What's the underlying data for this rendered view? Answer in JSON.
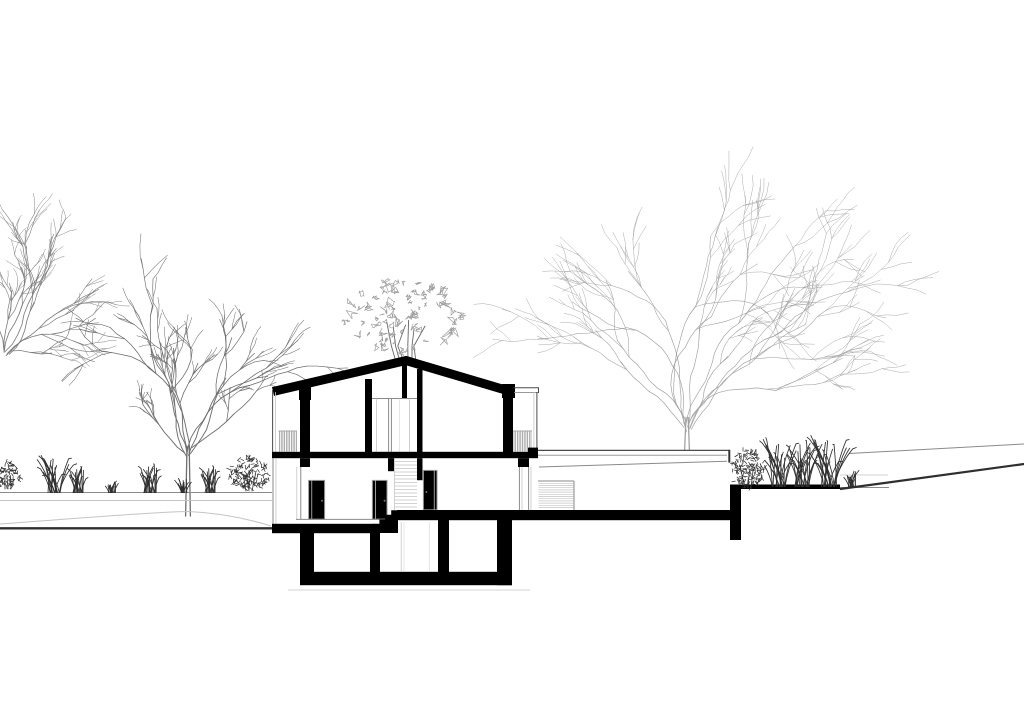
{
  "palette": {
    "background": "#ffffff",
    "ink": "#000000",
    "cut_line": "#2e2e2e",
    "line_dark": "#4a4a4a",
    "line_mid": "#8a8a8a",
    "line_light": "#c4c4c4",
    "tree_left_far": "#7d7d7d",
    "tree_left": "#6e6e6e",
    "tree_right": "#a2a2a2",
    "shrub_canopy": "#9c9c9c",
    "shrub_stem": "#666666",
    "plant": "#2f2f2f"
  },
  "scene": {
    "kind": "architectural cross-section drawing",
    "elements": [
      "house-section",
      "basement",
      "terrace-annex",
      "garden-trees",
      "grass-planting",
      "ground-profile"
    ]
  },
  "trees": [
    {
      "name": "tree-far-left",
      "type": "bare",
      "x": 6,
      "y": 352,
      "height": 205,
      "limbs": 8,
      "fan": 1.25,
      "lean": 0.62,
      "trunk_frac": 0.02,
      "width": 0.85,
      "color_key": "tree_left_far",
      "seed": 11
    },
    {
      "name": "tree-left",
      "type": "bare",
      "x": 188,
      "y": 516,
      "height": 232,
      "limbs": 9,
      "fan": 1.45,
      "lean": 0.0,
      "trunk_frac": 0.3,
      "width": 0.95,
      "color_key": "tree_left",
      "seed": 7
    },
    {
      "name": "shrub-behind-ridge",
      "type": "leafy",
      "x": 405,
      "y": 318,
      "rx": 62,
      "ry": 38,
      "base_y": 362,
      "clusters": 85,
      "color_key": "shrub_canopy",
      "stem_key": "shrub_stem",
      "seed": 5
    },
    {
      "name": "tree-right-large",
      "type": "bare",
      "x": 687,
      "y": 450,
      "height": 362,
      "limbs": 13,
      "fan": 1.35,
      "lean": 0.0,
      "trunk_frac": 0.09,
      "width": 0.68,
      "color_key": "tree_right",
      "seed": 3
    }
  ],
  "plants": [
    {
      "name": "shrub-left-edge",
      "type": "shrub",
      "x": 8,
      "y": 489,
      "h": 27,
      "w": 26,
      "seed": 21
    },
    {
      "name": "grass-clump-1",
      "type": "grass",
      "x": 55,
      "y": 493,
      "h": 38,
      "w": 26,
      "heads": true,
      "seed": 22
    },
    {
      "name": "grass-clump-2",
      "type": "grass",
      "x": 78,
      "y": 493,
      "h": 28,
      "w": 18,
      "heads": true,
      "seed": 23
    },
    {
      "name": "grass-tuft-1",
      "type": "grass",
      "x": 112,
      "y": 493,
      "h": 13,
      "w": 12,
      "heads": false,
      "seed": 24
    },
    {
      "name": "grass-clump-3",
      "type": "grass",
      "x": 150,
      "y": 493,
      "h": 31,
      "w": 22,
      "heads": true,
      "seed": 25
    },
    {
      "name": "grass-tuft-2",
      "type": "grass",
      "x": 184,
      "y": 493,
      "h": 15,
      "w": 12,
      "heads": false,
      "seed": 26
    },
    {
      "name": "grass-clump-4",
      "type": "grass",
      "x": 210,
      "y": 493,
      "h": 29,
      "w": 18,
      "heads": true,
      "seed": 27
    },
    {
      "name": "shrub-left-bed",
      "type": "shrub",
      "x": 249,
      "y": 491,
      "h": 34,
      "w": 40,
      "seed": 28
    },
    {
      "name": "shrub-right-bed",
      "type": "shrub",
      "x": 748,
      "y": 488,
      "h": 38,
      "w": 34,
      "seed": 29
    },
    {
      "name": "grass-tall-1",
      "type": "grass",
      "x": 780,
      "y": 487,
      "h": 48,
      "w": 26,
      "heads": true,
      "seed": 30
    },
    {
      "name": "grass-tall-2",
      "type": "grass",
      "x": 802,
      "y": 487,
      "h": 50,
      "w": 26,
      "heads": true,
      "seed": 31
    },
    {
      "name": "grass-tall-3",
      "type": "grass",
      "x": 829,
      "y": 487,
      "h": 52,
      "w": 28,
      "heads": true,
      "seed": 32
    },
    {
      "name": "grass-tuft-3",
      "type": "grass",
      "x": 852,
      "y": 487,
      "h": 18,
      "w": 12,
      "heads": false,
      "seed": 33
    }
  ]
}
